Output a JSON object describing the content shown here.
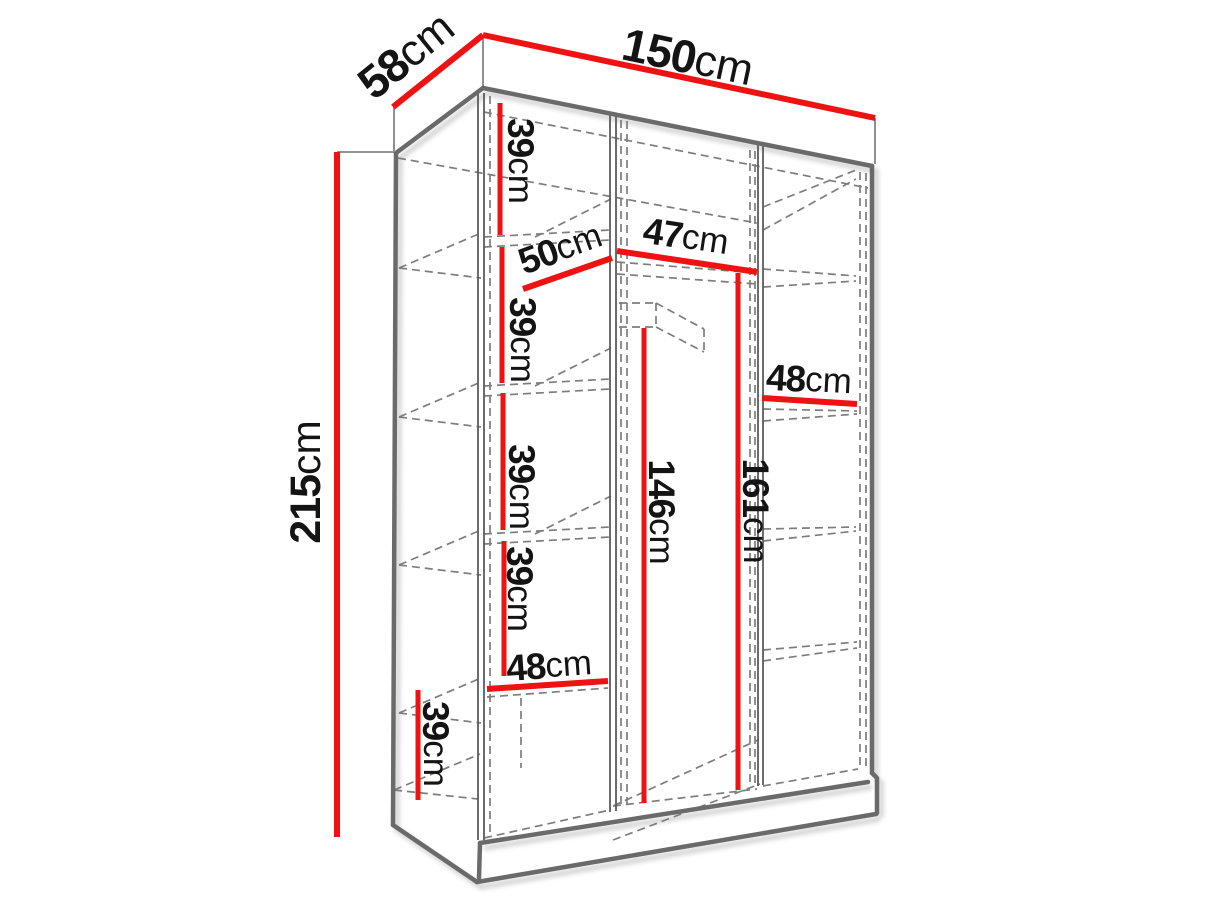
{
  "diagram": {
    "kind": "wardrobe-dimension-diagram",
    "colors": {
      "dimension_red": "#ee1212",
      "carcass_gray": "#6a6a6a",
      "edge_gray": "#5c5c5c",
      "hidden_line_gray": "#7d7d7d",
      "shadow_gray": "#9a9a9a",
      "label_black": "#141414",
      "background": "#ffffff"
    },
    "dimensions": [
      {
        "id": "overall-width",
        "value": "150",
        "unit": "cm"
      },
      {
        "id": "overall-depth",
        "value": "58",
        "unit": "cm"
      },
      {
        "id": "overall-height",
        "value": "215",
        "unit": "cm"
      },
      {
        "id": "left-shelf-height-1",
        "value": "39",
        "unit": "cm"
      },
      {
        "id": "shelf-depth",
        "value": "50",
        "unit": "cm"
      },
      {
        "id": "middle-section-width",
        "value": "47",
        "unit": "cm"
      },
      {
        "id": "left-shelf-height-2",
        "value": "39",
        "unit": "cm"
      },
      {
        "id": "right-section-width",
        "value": "48",
        "unit": "cm"
      },
      {
        "id": "left-shelf-height-3",
        "value": "39",
        "unit": "cm"
      },
      {
        "id": "left-shelf-height-4",
        "value": "39",
        "unit": "cm"
      },
      {
        "id": "hanging-space-height",
        "value": "146",
        "unit": "cm"
      },
      {
        "id": "partition-height",
        "value": "161",
        "unit": "cm"
      },
      {
        "id": "left-section-width",
        "value": "48",
        "unit": "cm"
      },
      {
        "id": "bottom-shelf-height",
        "value": "39",
        "unit": "cm"
      }
    ]
  }
}
